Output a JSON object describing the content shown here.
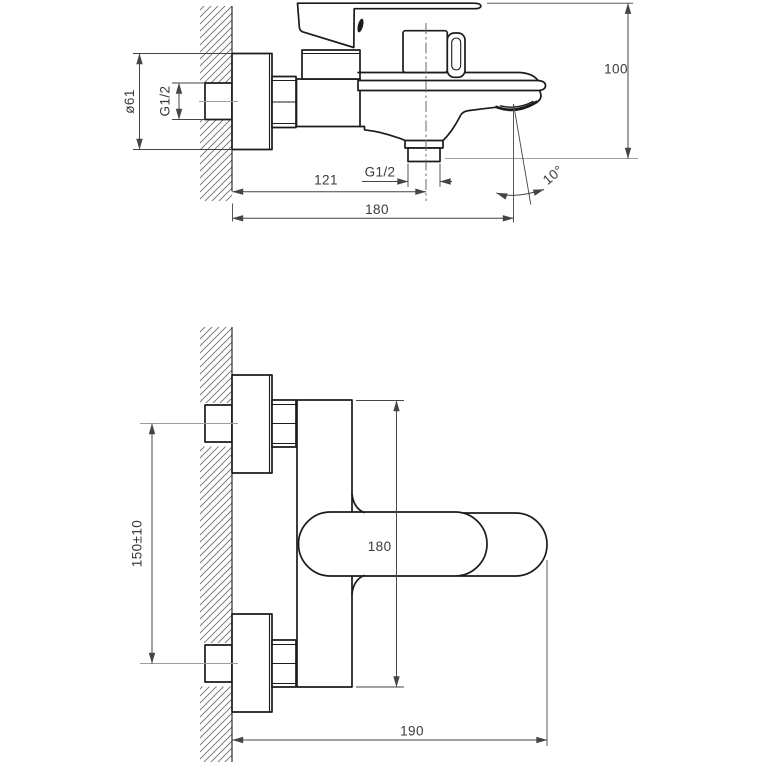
{
  "title": "wall-mounted-bath-mixer-installation-drawing",
  "colors": {
    "background": "#ffffff",
    "outline": "#1b1b1b",
    "dimension_lines": "#454545",
    "text": "#3a3a3a",
    "hatch": "#6f6f6f",
    "centerline": "#9e9e9e"
  },
  "views": {
    "side": {
      "label": "side-view",
      "dims": {
        "flange_diameter": "ø61",
        "inlet_thread": "G1/2",
        "outlet_thread": "G1/2",
        "wall_to_outlet_center": "121",
        "wall_to_spout_tip": "180",
        "overall_height": "100",
        "spout_angle": "10°"
      }
    },
    "front": {
      "label": "front-view",
      "dims": {
        "inlet_centers_distance": "150±10",
        "body_height": "180",
        "overall_depth": "190"
      }
    }
  }
}
